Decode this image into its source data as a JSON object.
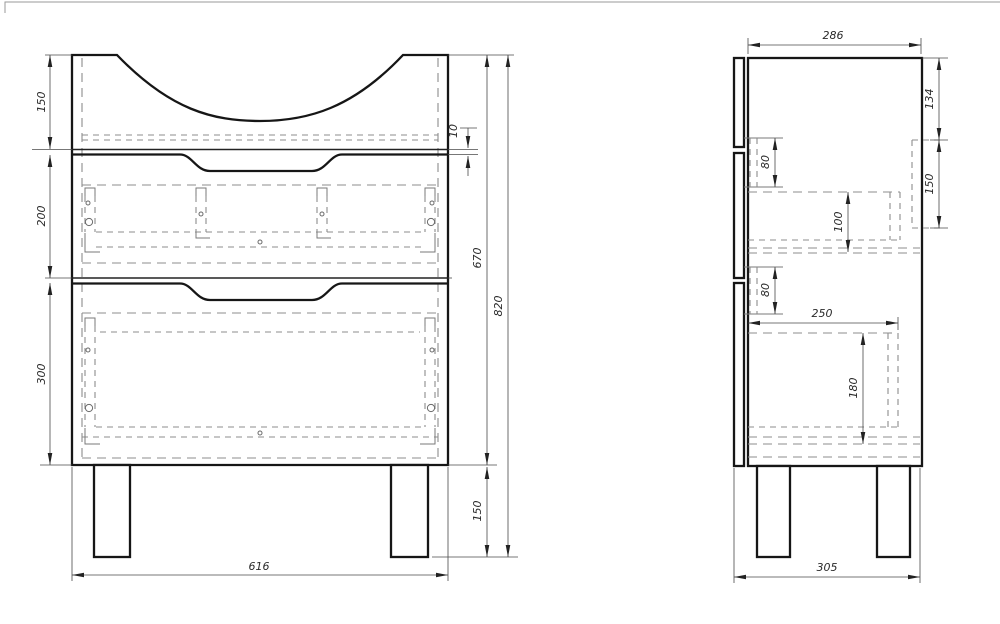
{
  "drawing": {
    "kind": "furniture technical drawing",
    "colors": {
      "outline": "#161616",
      "dashed": "#8c8c8c",
      "dimension": "#4a4a4a",
      "background": "#ffffff"
    }
  },
  "dims": {
    "front": {
      "top_section": "150",
      "drawer1": "200",
      "drawer2": "300",
      "gap": "10",
      "body_height": "670",
      "total_height": "820",
      "legs": "150",
      "width": "616"
    },
    "side": {
      "depth": "286",
      "top_offset": "134",
      "rail": "150",
      "slide1": "80",
      "box1": "100",
      "slide2": "80",
      "box2_depth": "250",
      "box2_height": "180",
      "total_depth": "305"
    }
  }
}
